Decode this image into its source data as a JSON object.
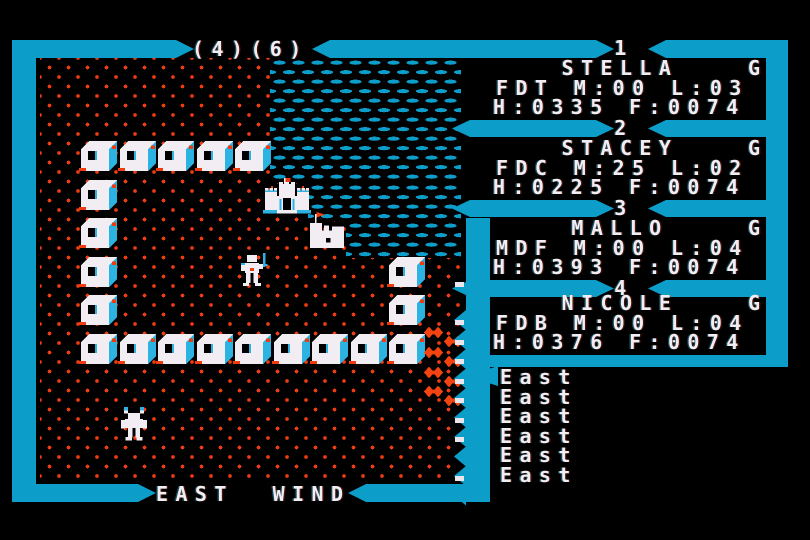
{
  "colors": {
    "border_cyan": "#0d9dc9",
    "accent_cyan": "#2cb3e2",
    "dot_red": "#ee3c10",
    "lava_red": "#f34311",
    "text_white": "#f1edf3",
    "background": "#000000"
  },
  "header": {
    "coords": "(4)(6)"
  },
  "wind": {
    "label": "EAST  WIND"
  },
  "party": [
    {
      "slot": "1",
      "name": "STELLA",
      "status": "G",
      "stats": "FDT M:00 L:03",
      "vitals": "H:0335 F:0074"
    },
    {
      "slot": "2",
      "name": "STACEY",
      "status": "G",
      "stats": "FDC M:25 L:02",
      "vitals": "H:0225 F:0074"
    },
    {
      "slot": "3",
      "name": "MALLO",
      "status": "G",
      "stats": "MDF M:00 L:04",
      "vitals": "H:0393 F:0074"
    },
    {
      "slot": "4",
      "name": "NICOLE",
      "status": "G",
      "stats": "FDB M:00 L:04",
      "vitals": "H:0376 F:0074"
    }
  ],
  "log": {
    "entries": [
      "East",
      "East",
      "East",
      "East",
      "East",
      "East"
    ]
  },
  "map": {
    "origin": {
      "x": 40,
      "y": 67
    },
    "tile": 38.5,
    "terrain_default": "grass",
    "water_regions": [
      {
        "x": 270,
        "y": 58,
        "w": 191,
        "h": 125
      },
      {
        "x": 308,
        "y": 183,
        "w": 153,
        "h": 38
      },
      {
        "x": 346,
        "y": 221,
        "w": 115,
        "h": 37
      }
    ],
    "dungeon_boxes": [
      [
        1,
        2
      ],
      [
        2,
        2
      ],
      [
        3,
        2
      ],
      [
        4,
        2
      ],
      [
        5,
        2
      ],
      [
        1,
        3
      ],
      [
        1,
        4
      ],
      [
        1,
        5
      ],
      [
        1,
        6
      ],
      [
        1,
        7
      ],
      [
        2,
        7
      ],
      [
        3,
        7
      ],
      [
        4,
        7
      ],
      [
        5,
        7
      ],
      [
        6,
        7
      ],
      [
        7,
        7
      ],
      [
        8,
        7
      ],
      [
        9,
        7
      ],
      [
        9,
        5
      ],
      [
        9,
        6
      ]
    ],
    "buildings": [
      {
        "type": "castle",
        "col": 6,
        "row": 3
      },
      {
        "type": "town",
        "col": 7,
        "row": 4
      }
    ],
    "figures": [
      {
        "type": "fighter",
        "col": 5,
        "row": 5
      },
      {
        "type": "creature",
        "col": 2,
        "row": 9
      }
    ],
    "lava_fields": [
      {
        "x": 424,
        "y": 326
      },
      {
        "x": 444,
        "y": 335
      },
      {
        "x": 424,
        "y": 346
      },
      {
        "x": 444,
        "y": 355
      },
      {
        "x": 424,
        "y": 366
      },
      {
        "x": 444,
        "y": 375
      },
      {
        "x": 424,
        "y": 385
      },
      {
        "x": 444,
        "y": 394
      }
    ]
  }
}
